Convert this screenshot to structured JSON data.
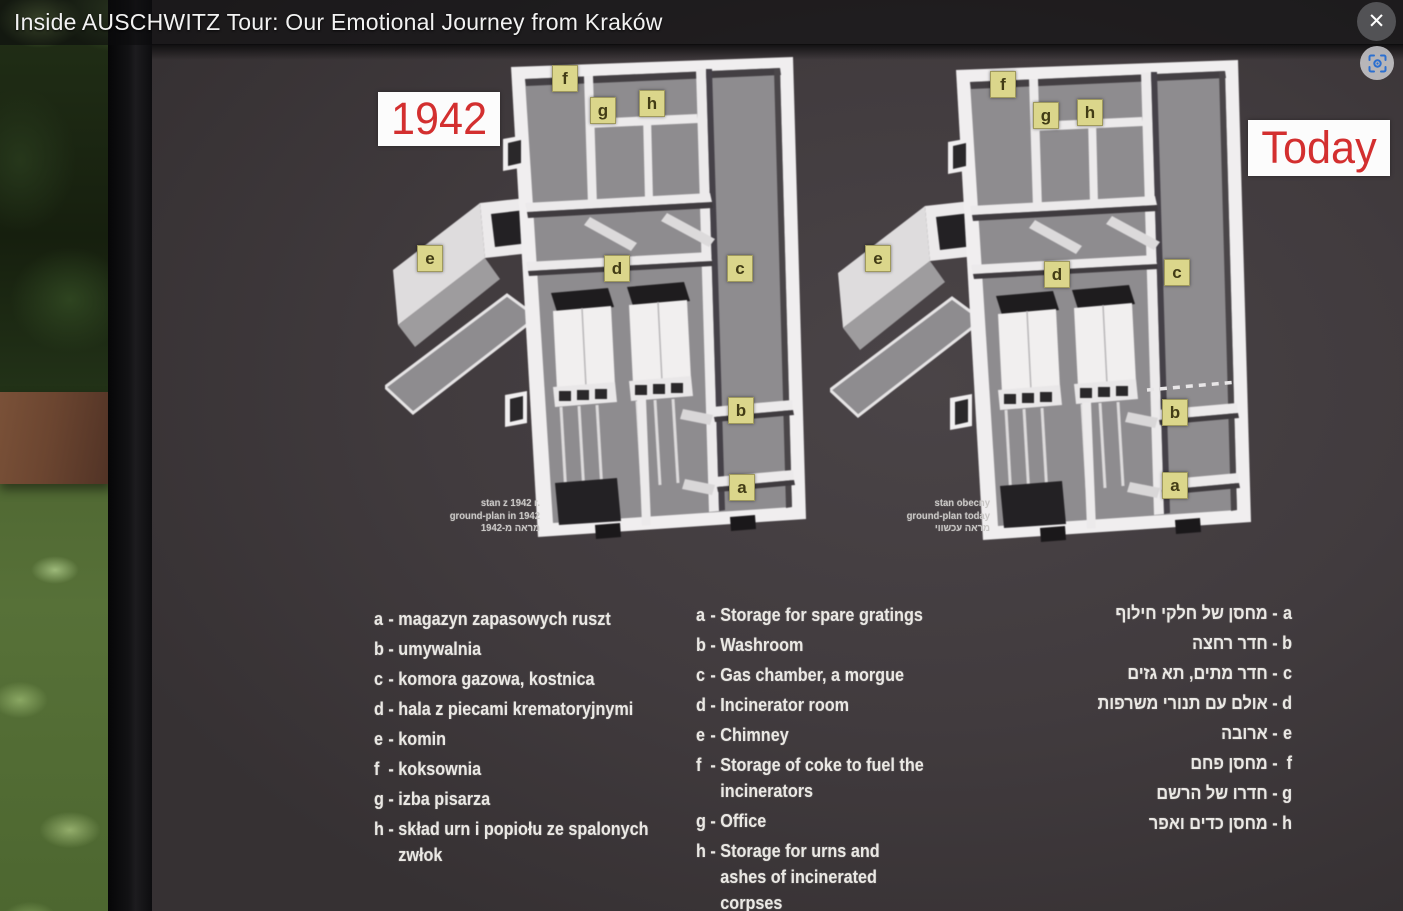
{
  "window": {
    "title": "Inside AUSCHWITZ Tour: Our Emotional Journey from Kraków",
    "close_glyph": "✕"
  },
  "labels": {
    "left_diagram": "1942",
    "right_diagram": "Today"
  },
  "markers": [
    "f",
    "g",
    "h",
    "e",
    "d",
    "c",
    "b",
    "a"
  ],
  "captions": {
    "left": {
      "pl": "stan z 1942 r.",
      "en": "ground-plan in 1942",
      "he": "מראה מ-1942"
    },
    "right": {
      "pl": "stan obecny",
      "en": "ground-plan today",
      "he": "מראה עכשווי"
    }
  },
  "legend": {
    "separator": "-",
    "polish": [
      {
        "key": "a",
        "text": "magazyn zapasowych ruszt"
      },
      {
        "key": "b",
        "text": "umywalnia"
      },
      {
        "key": "c",
        "text": "komora gazowa, kostnica"
      },
      {
        "key": "d",
        "text": "hala z piecami krematoryjnymi"
      },
      {
        "key": "e",
        "text": "komin"
      },
      {
        "key": "f",
        "text": "koksownia"
      },
      {
        "key": "g",
        "text": "izba pisarza"
      },
      {
        "key": "h",
        "text": "skład urn i popiołu ze spalonych zwłok"
      }
    ],
    "english": [
      {
        "key": "a",
        "text": "Storage for spare gratings"
      },
      {
        "key": "b",
        "text": "Washroom"
      },
      {
        "key": "c",
        "text": "Gas chamber, a morgue"
      },
      {
        "key": "d",
        "text": "Incinerator room"
      },
      {
        "key": "e",
        "text": "Chimney"
      },
      {
        "key": "f",
        "text": "Storage of coke to fuel the incinerators"
      },
      {
        "key": "g",
        "text": "Office"
      },
      {
        "key": "h",
        "text": "Storage for urns and ashes of incinerated corpses"
      }
    ],
    "hebrew": [
      {
        "key": "a",
        "text": "מחסן של חלקי חילוף"
      },
      {
        "key": "b",
        "text": "חדר רחצה"
      },
      {
        "key": "c",
        "text": "חדר מתים, תא גזים"
      },
      {
        "key": "d",
        "text": "אולם עם תנורי משרפות"
      },
      {
        "key": "e",
        "text": "ארובה"
      },
      {
        "key": "f",
        "text": "מחסן פחם"
      },
      {
        "key": "g",
        "text": "חדרו של הרשם"
      },
      {
        "key": "h",
        "text": "מחסן כדים ואפר"
      }
    ]
  }
}
